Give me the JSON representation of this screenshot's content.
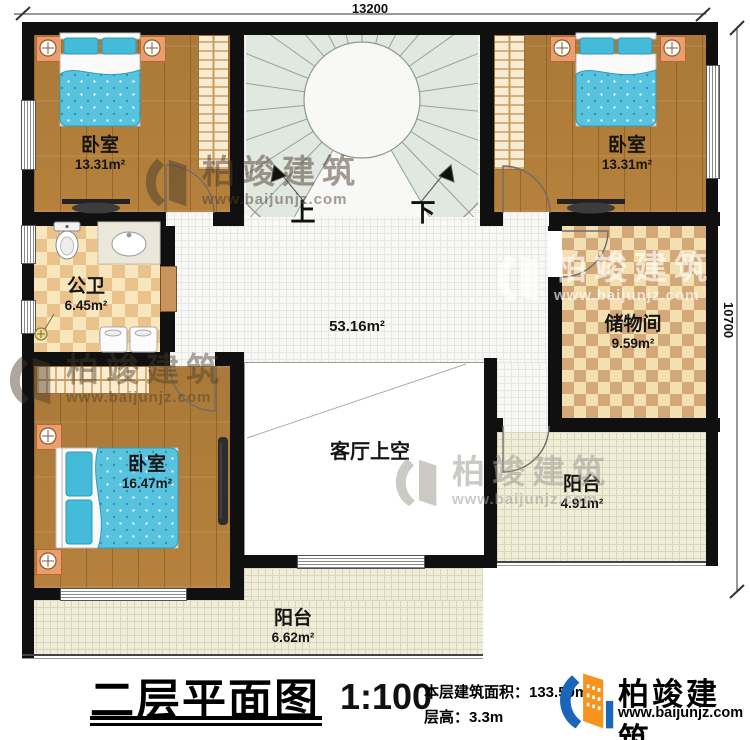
{
  "dimensions": {
    "top": "13200",
    "right": "10700"
  },
  "rooms": {
    "bedroom_tl": {
      "name": "卧室",
      "area": "13.31m²"
    },
    "bedroom_tr": {
      "name": "卧室",
      "area": "13.31m²"
    },
    "bathroom": {
      "name": "公卫",
      "area": "6.45m²"
    },
    "hall": {
      "area": "53.16m²"
    },
    "storage": {
      "name": "储物间",
      "area": "9.59m²"
    },
    "bedroom_bl": {
      "name": "卧室",
      "area": "16.47m²"
    },
    "void": {
      "name": "客厅上空"
    },
    "balcony_right": {
      "name": "阳台",
      "area": "4.91m²"
    },
    "balcony_bottom": {
      "name": "阳台",
      "area": "6.62m²"
    }
  },
  "stairs": {
    "up_label": "上",
    "down_label": "下"
  },
  "title_block": {
    "plan_title": "二层平面图",
    "scale": "1:100",
    "area_line": "本层建筑面积：133.59m²",
    "height_line": "层高：3.3m"
  },
  "brand": {
    "name": "柏竣建筑",
    "website": "www.baijunjz.com"
  },
  "colors": {
    "accent_blue": "#1a66b8",
    "accent_orange": "#f7941d",
    "wall": "#101010",
    "bed": "#58c3de"
  }
}
